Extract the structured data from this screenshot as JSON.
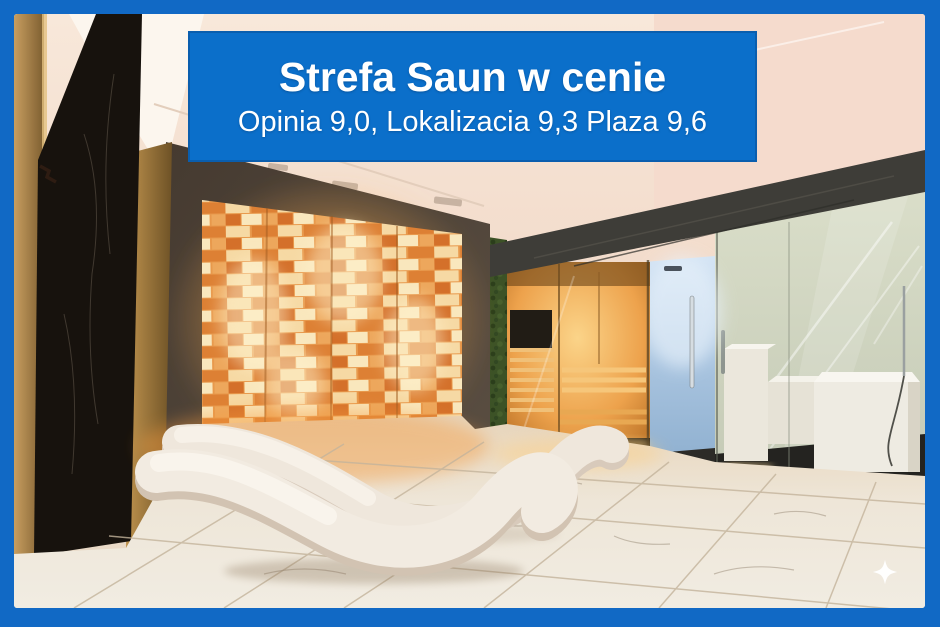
{
  "frame": {
    "border_color": "#1169c5"
  },
  "banner": {
    "title": "Strefa Saun w cenie",
    "subtitle": "Opinia 9,0, Lokalizacia 9,3 Plaza 9,6",
    "ratings": [
      {
        "label": "Opinia",
        "value": "9,0"
      },
      {
        "label": "Lokalizacia",
        "value": "9,3"
      },
      {
        "label": "Plaza",
        "value": "9,6"
      }
    ],
    "background_color": "#0b6fca",
    "text_color": "#ffffff"
  },
  "photo": {
    "alt": "Hotel spa sauna zone: backlit amber salt wall, two white wave-shaped loungers on marble floor, green moss wall, wooden sauna cabin, blue-lit shower and frosted-glass steam room with white bench",
    "palette": {
      "salt_wall": "#e8984c",
      "sauna_wood": "#c98a3e",
      "marble_floor": "#ece5d8",
      "dark_marble": "#17120d",
      "moss_wall": "#3c5226",
      "shower_light": "#b9d0e6",
      "frosted_glass": "#d3d8c6",
      "ceiling": "#f7e3d5"
    }
  },
  "icons": {
    "sparkle": "four-point-star"
  }
}
